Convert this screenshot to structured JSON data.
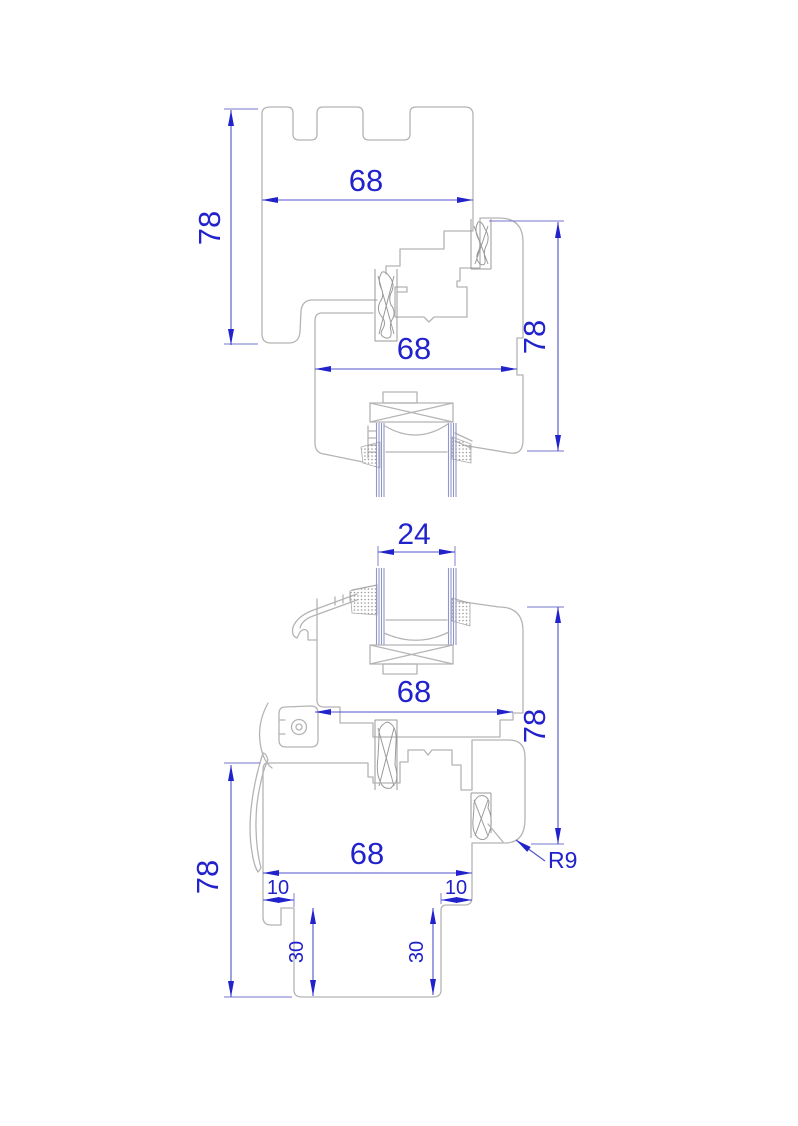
{
  "drawing": {
    "top_section": {
      "frame_width": "68",
      "frame_height": "78",
      "sash_width": "68",
      "sash_height": "78"
    },
    "bottom_section": {
      "glazing_thickness": "24",
      "sash_width": "68",
      "height_right": "78",
      "frame_width": "68",
      "height_left": "78",
      "offset_left": "10",
      "offset_right": "10",
      "groove_depth_left": "30",
      "groove_depth_right": "30",
      "corner_radius": "R9"
    }
  },
  "colors": {
    "dimension_text": "#2222cc",
    "dimension_line": "#5050cc",
    "profile_line": "#b4b4b4",
    "gasket_line": "#9a9a9a",
    "glass_line": "#9297c9",
    "background": "#ffffff"
  }
}
